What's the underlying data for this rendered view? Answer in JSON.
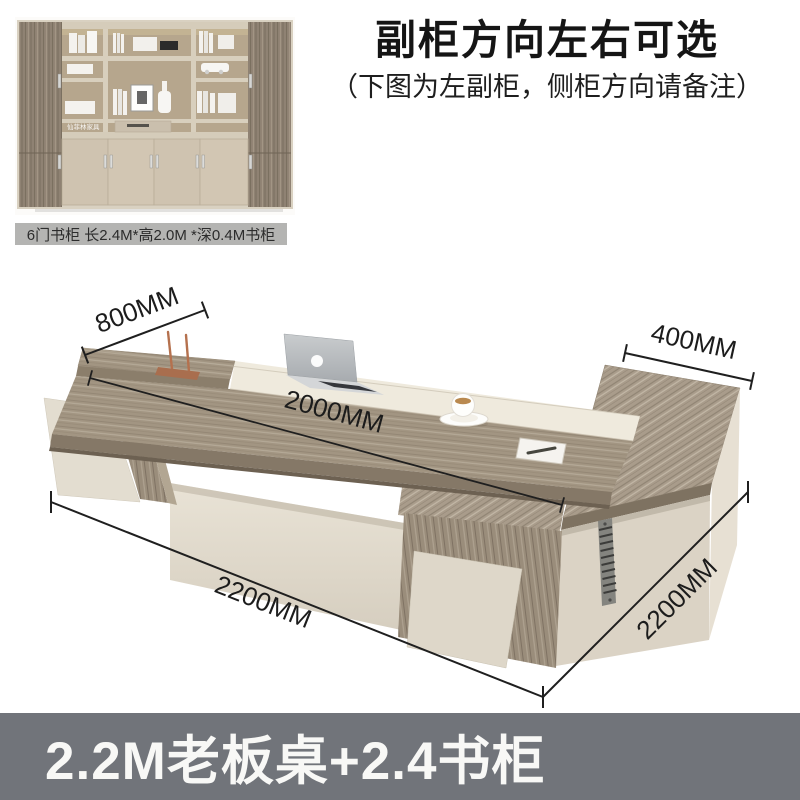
{
  "headline": {
    "title": "副柜方向左右可选",
    "subtitle": "（下图为左副柜，侧柜方向请备注）"
  },
  "bookcase": {
    "caption": "6门书柜 长2.4M*高2.0M *深0.4M书柜",
    "watermark": "仙菲林家具"
  },
  "desk_dimensions": {
    "left_depth": "800MM",
    "desktop_length": "2000MM",
    "return_depth": "400MM",
    "front_length": "2200MM",
    "side_length": "2200MM"
  },
  "banner": {
    "label": "2.2M老板桌+2.4书柜"
  },
  "colors": {
    "wood": "#a29582",
    "wood_dark": "#857867",
    "cream": "#efeadd",
    "panel_cream": "#ded7c9",
    "caption_bg": "#b4b4b2",
    "banner_bg": "#71747a",
    "dimension_line": "#1f1f1f"
  }
}
